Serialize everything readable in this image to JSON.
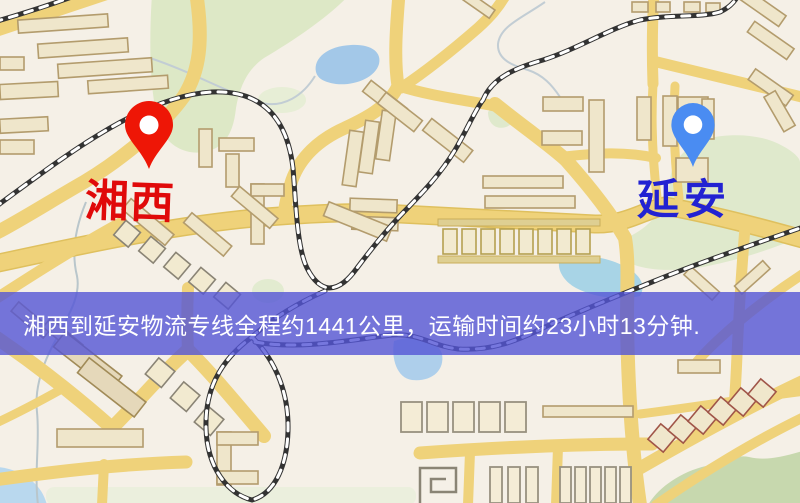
{
  "banner": {
    "text": "湘西到延安物流专线全程约1441公里，运输时间约23小时13分钟.",
    "background_color": "rgba(84,85,214,0.80)",
    "text_color": "#ffffff"
  },
  "markers": {
    "origin": {
      "label": "湘西",
      "label_color": "#e00a0a",
      "pin_color": "#ee1606",
      "pin_style": "map-pin"
    },
    "destination": {
      "label": "延安",
      "label_color": "#2222d2",
      "pin_color": "#4a8cf2",
      "pin_style": "map-pin"
    }
  },
  "map": {
    "colors": {
      "background": "#f5f0e7",
      "road_yellow": "#efd27a",
      "road_casing": "#dfc05e",
      "building_fill": "#efe6cb",
      "building_stroke": "#b39c6d",
      "park_green": "#dde8c6",
      "hill_green": "#c7d8ae",
      "water_blue": "#a3c8e8",
      "railway_dark": "#333333"
    }
  }
}
